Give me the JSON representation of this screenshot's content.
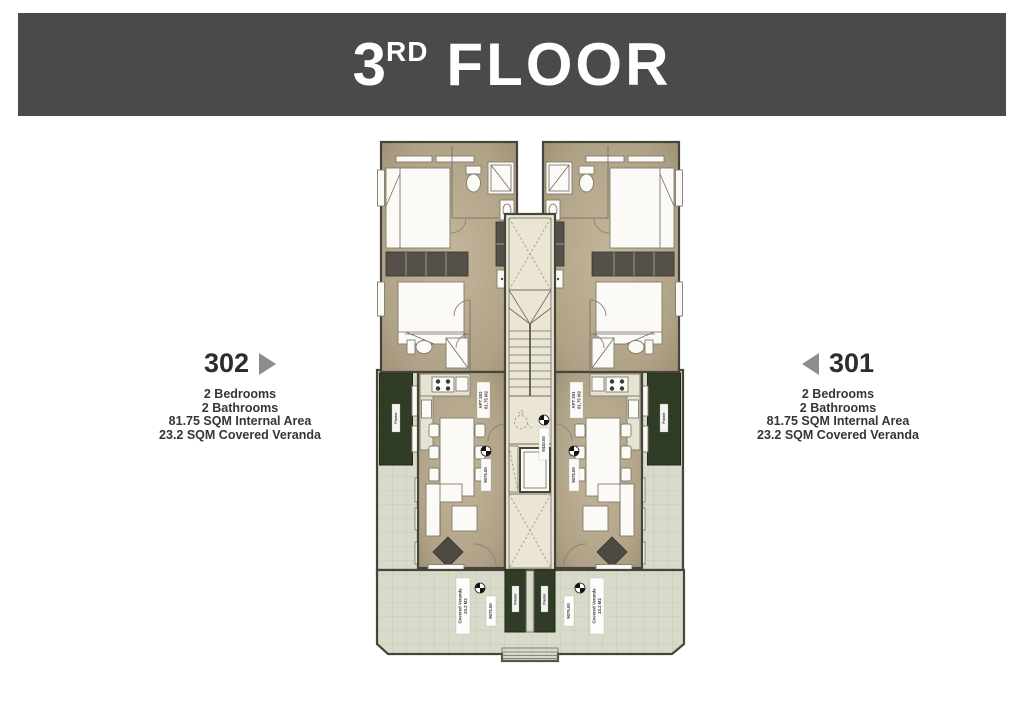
{
  "banner": {
    "number": "3",
    "ordinal": "RD",
    "word": "FLOOR",
    "bg": "#4a4a4a",
    "text_color": "#ffffff"
  },
  "unit_left": {
    "number": "302",
    "details": [
      "2 Bedrooms",
      "2 Bathrooms",
      "81.75 SQM Internal Area",
      "23.2 SQM Covered Veranda"
    ]
  },
  "unit_right": {
    "number": "301",
    "details": [
      "2 Bedrooms",
      "2 Bathrooms",
      "81.75 SQM Internal Area",
      "23.2 SQM Covered Veranda"
    ]
  },
  "plan": {
    "apt_left_line1": "APT 302",
    "apt_left_line2": "81.75 M2",
    "apt_right_line1": "APT 301",
    "apt_right_line2": "81.75 M2",
    "veranda_line1": "Covered Veranda",
    "veranda_line2": "23.2 M2",
    "planter": "Planter",
    "level_hall": "9410.00",
    "level_living": "9075.00",
    "level_veranda": "9075.00"
  },
  "colors": {
    "banner_bg": "#4a4a4a",
    "arrow_gray": "#8d8d8d",
    "floor_tan": "#b3a68b",
    "planter_green": "#313c26"
  }
}
